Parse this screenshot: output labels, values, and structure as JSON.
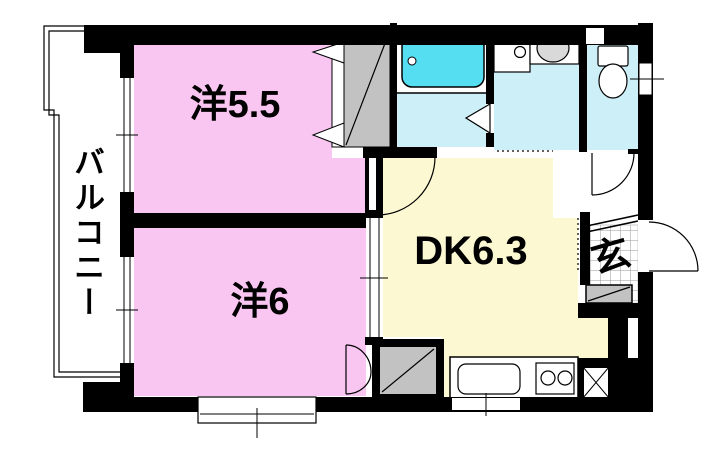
{
  "labels": {
    "balcony": "バルコニー",
    "western_room_5_5": "洋5.5",
    "western_room_6": "洋6",
    "dining_kitchen": "DK6.3",
    "entrance": "玄"
  },
  "rooms": [
    {
      "name": "バルコニー",
      "type": "balcony"
    },
    {
      "name": "洋5.5",
      "type": "western-style-room",
      "size_tatami": "5.5"
    },
    {
      "name": "洋6",
      "type": "western-style-room",
      "size_tatami": "6"
    },
    {
      "name": "DK6.3",
      "type": "dining-kitchen",
      "size_tatami": "6.3"
    },
    {
      "name": "玄",
      "type": "entrance-genkan"
    }
  ],
  "colors": {
    "wall": "#000000",
    "western_room_fill": "#f9c6f2",
    "dining_kitchen_fill": "#fcf8d2",
    "wet_area_fill": "#cdeff8",
    "bathtub_fill": "#55def2",
    "closet_fill": "#c2c2c2",
    "fixture_fill": "#ffffff",
    "basin_fill": "#d9d9d9"
  }
}
